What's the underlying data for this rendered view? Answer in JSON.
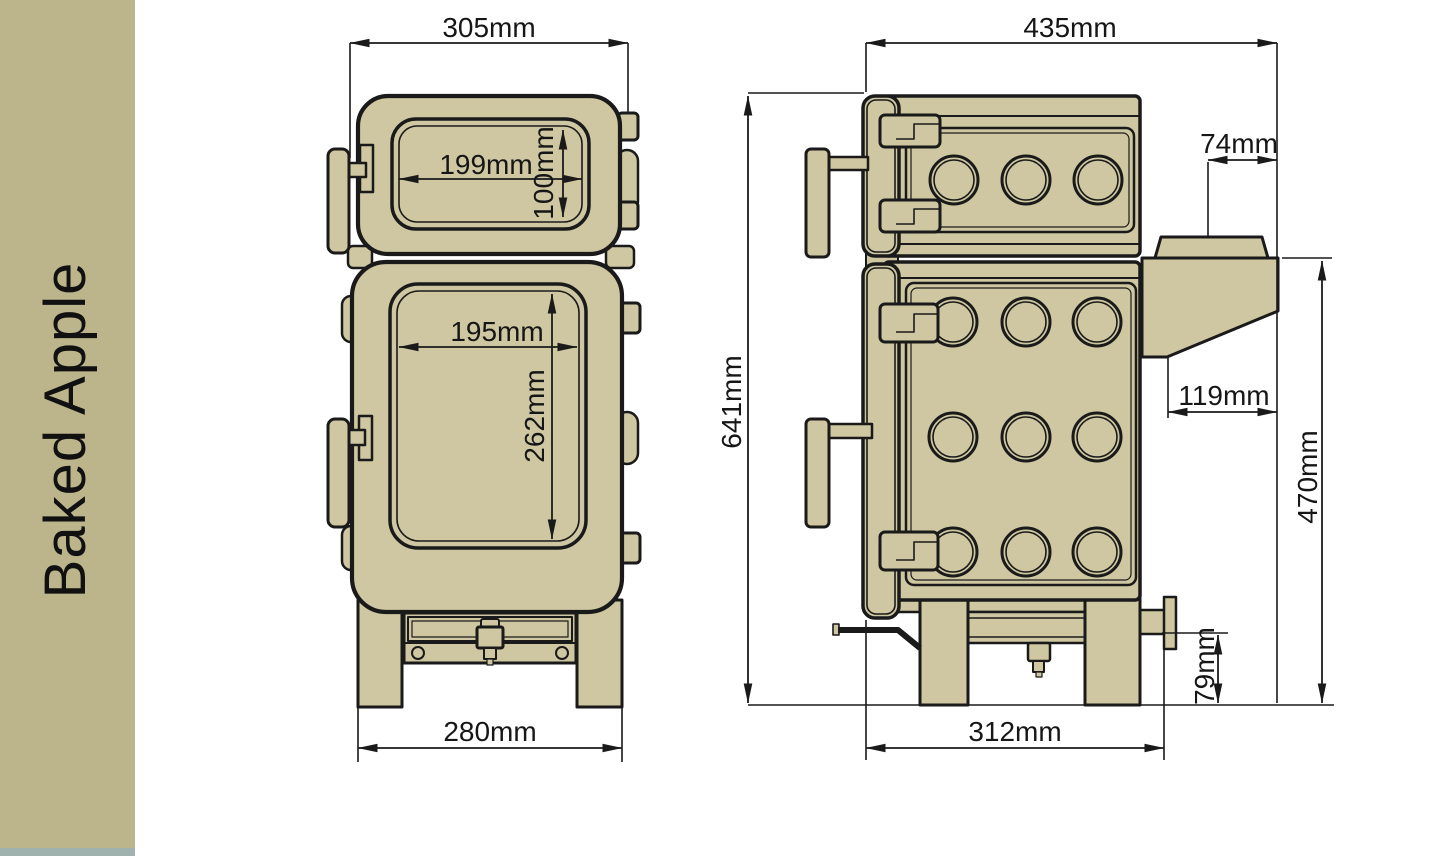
{
  "sidebar": {
    "title": "Baked Apple",
    "bg_color": "#bcb48a",
    "strip_color": "#9fb2ae"
  },
  "drawing": {
    "fill_color": "#cfc7a1",
    "line_color": "#1a1a1a",
    "views": {
      "front_label": "front view",
      "side_label": "side view"
    },
    "dimensions": {
      "front_overall_width": "305mm",
      "upper_window_width": "199mm",
      "upper_window_height": "100mm",
      "lower_window_width": "195mm",
      "lower_window_height": "262mm",
      "front_base_width": "280mm",
      "side_overall_depth": "435mm",
      "flue_offset": "74mm",
      "overall_height": "641mm",
      "rear_gap": "119mm",
      "rear_height": "470mm",
      "outlet_height": "79mm",
      "base_depth": "312mm"
    }
  }
}
